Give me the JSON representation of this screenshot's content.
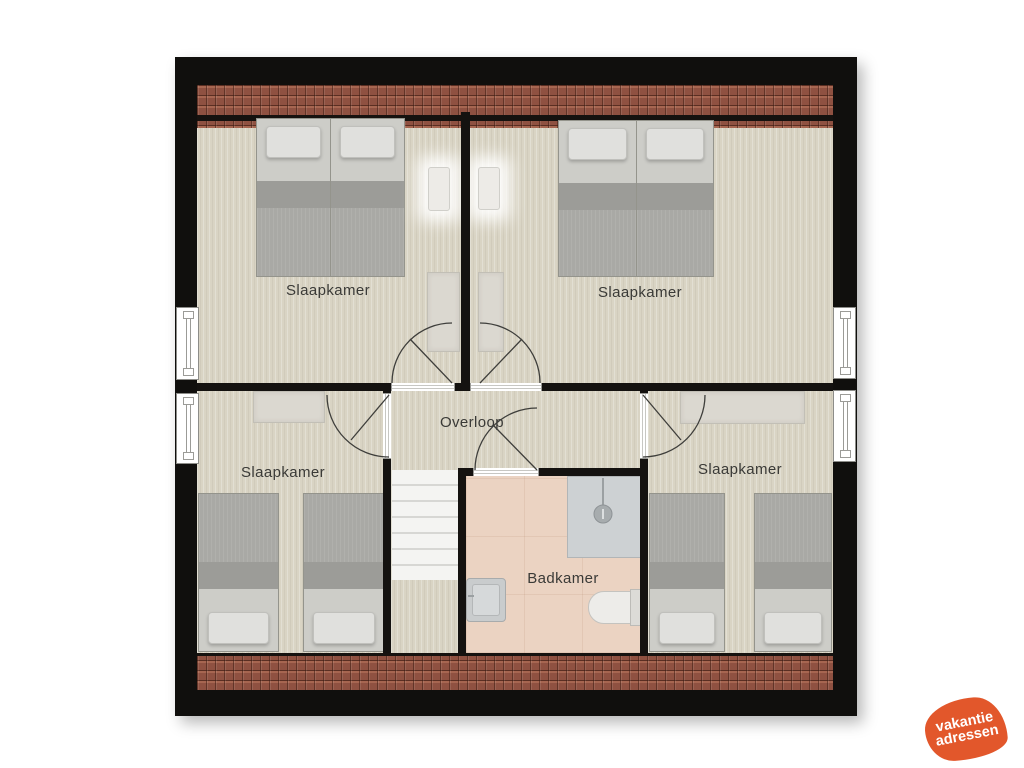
{
  "floorplan": {
    "rooms": [
      {
        "id": "bedroom-top-left",
        "label": "Slaapkamer"
      },
      {
        "id": "bedroom-top-right",
        "label": "Slaapkamer"
      },
      {
        "id": "bedroom-bottom-left",
        "label": "Slaapkamer"
      },
      {
        "id": "bedroom-bottom-right",
        "label": "Slaapkamer"
      },
      {
        "id": "landing",
        "label": "Overloop"
      },
      {
        "id": "bathroom",
        "label": "Badkamer"
      }
    ],
    "fixtures": [
      "twin-bed",
      "pillow",
      "desk",
      "dresser",
      "wall-lamp",
      "stairs",
      "shower",
      "sink",
      "toilet",
      "window",
      "door",
      "roof-tiles"
    ],
    "counts": {
      "bedrooms": 4,
      "beds": 8,
      "windows": 4,
      "doors": 5
    },
    "colors": {
      "wall": "#141210",
      "floor": "#d9d4c4",
      "bathroom_floor": "#ebd3c2",
      "roof_tile": "#8f5141",
      "bed_blanket": "#a9a9a5",
      "bed_head": "#cdcdc8",
      "furniture": "#dbd8d0",
      "shower": "#cdd1d3",
      "label_text": "#3a3a37"
    }
  },
  "logo": {
    "line1": "vakantie",
    "line2": "adressen",
    "background": "#e2572b",
    "text_color": "#ffffff"
  }
}
